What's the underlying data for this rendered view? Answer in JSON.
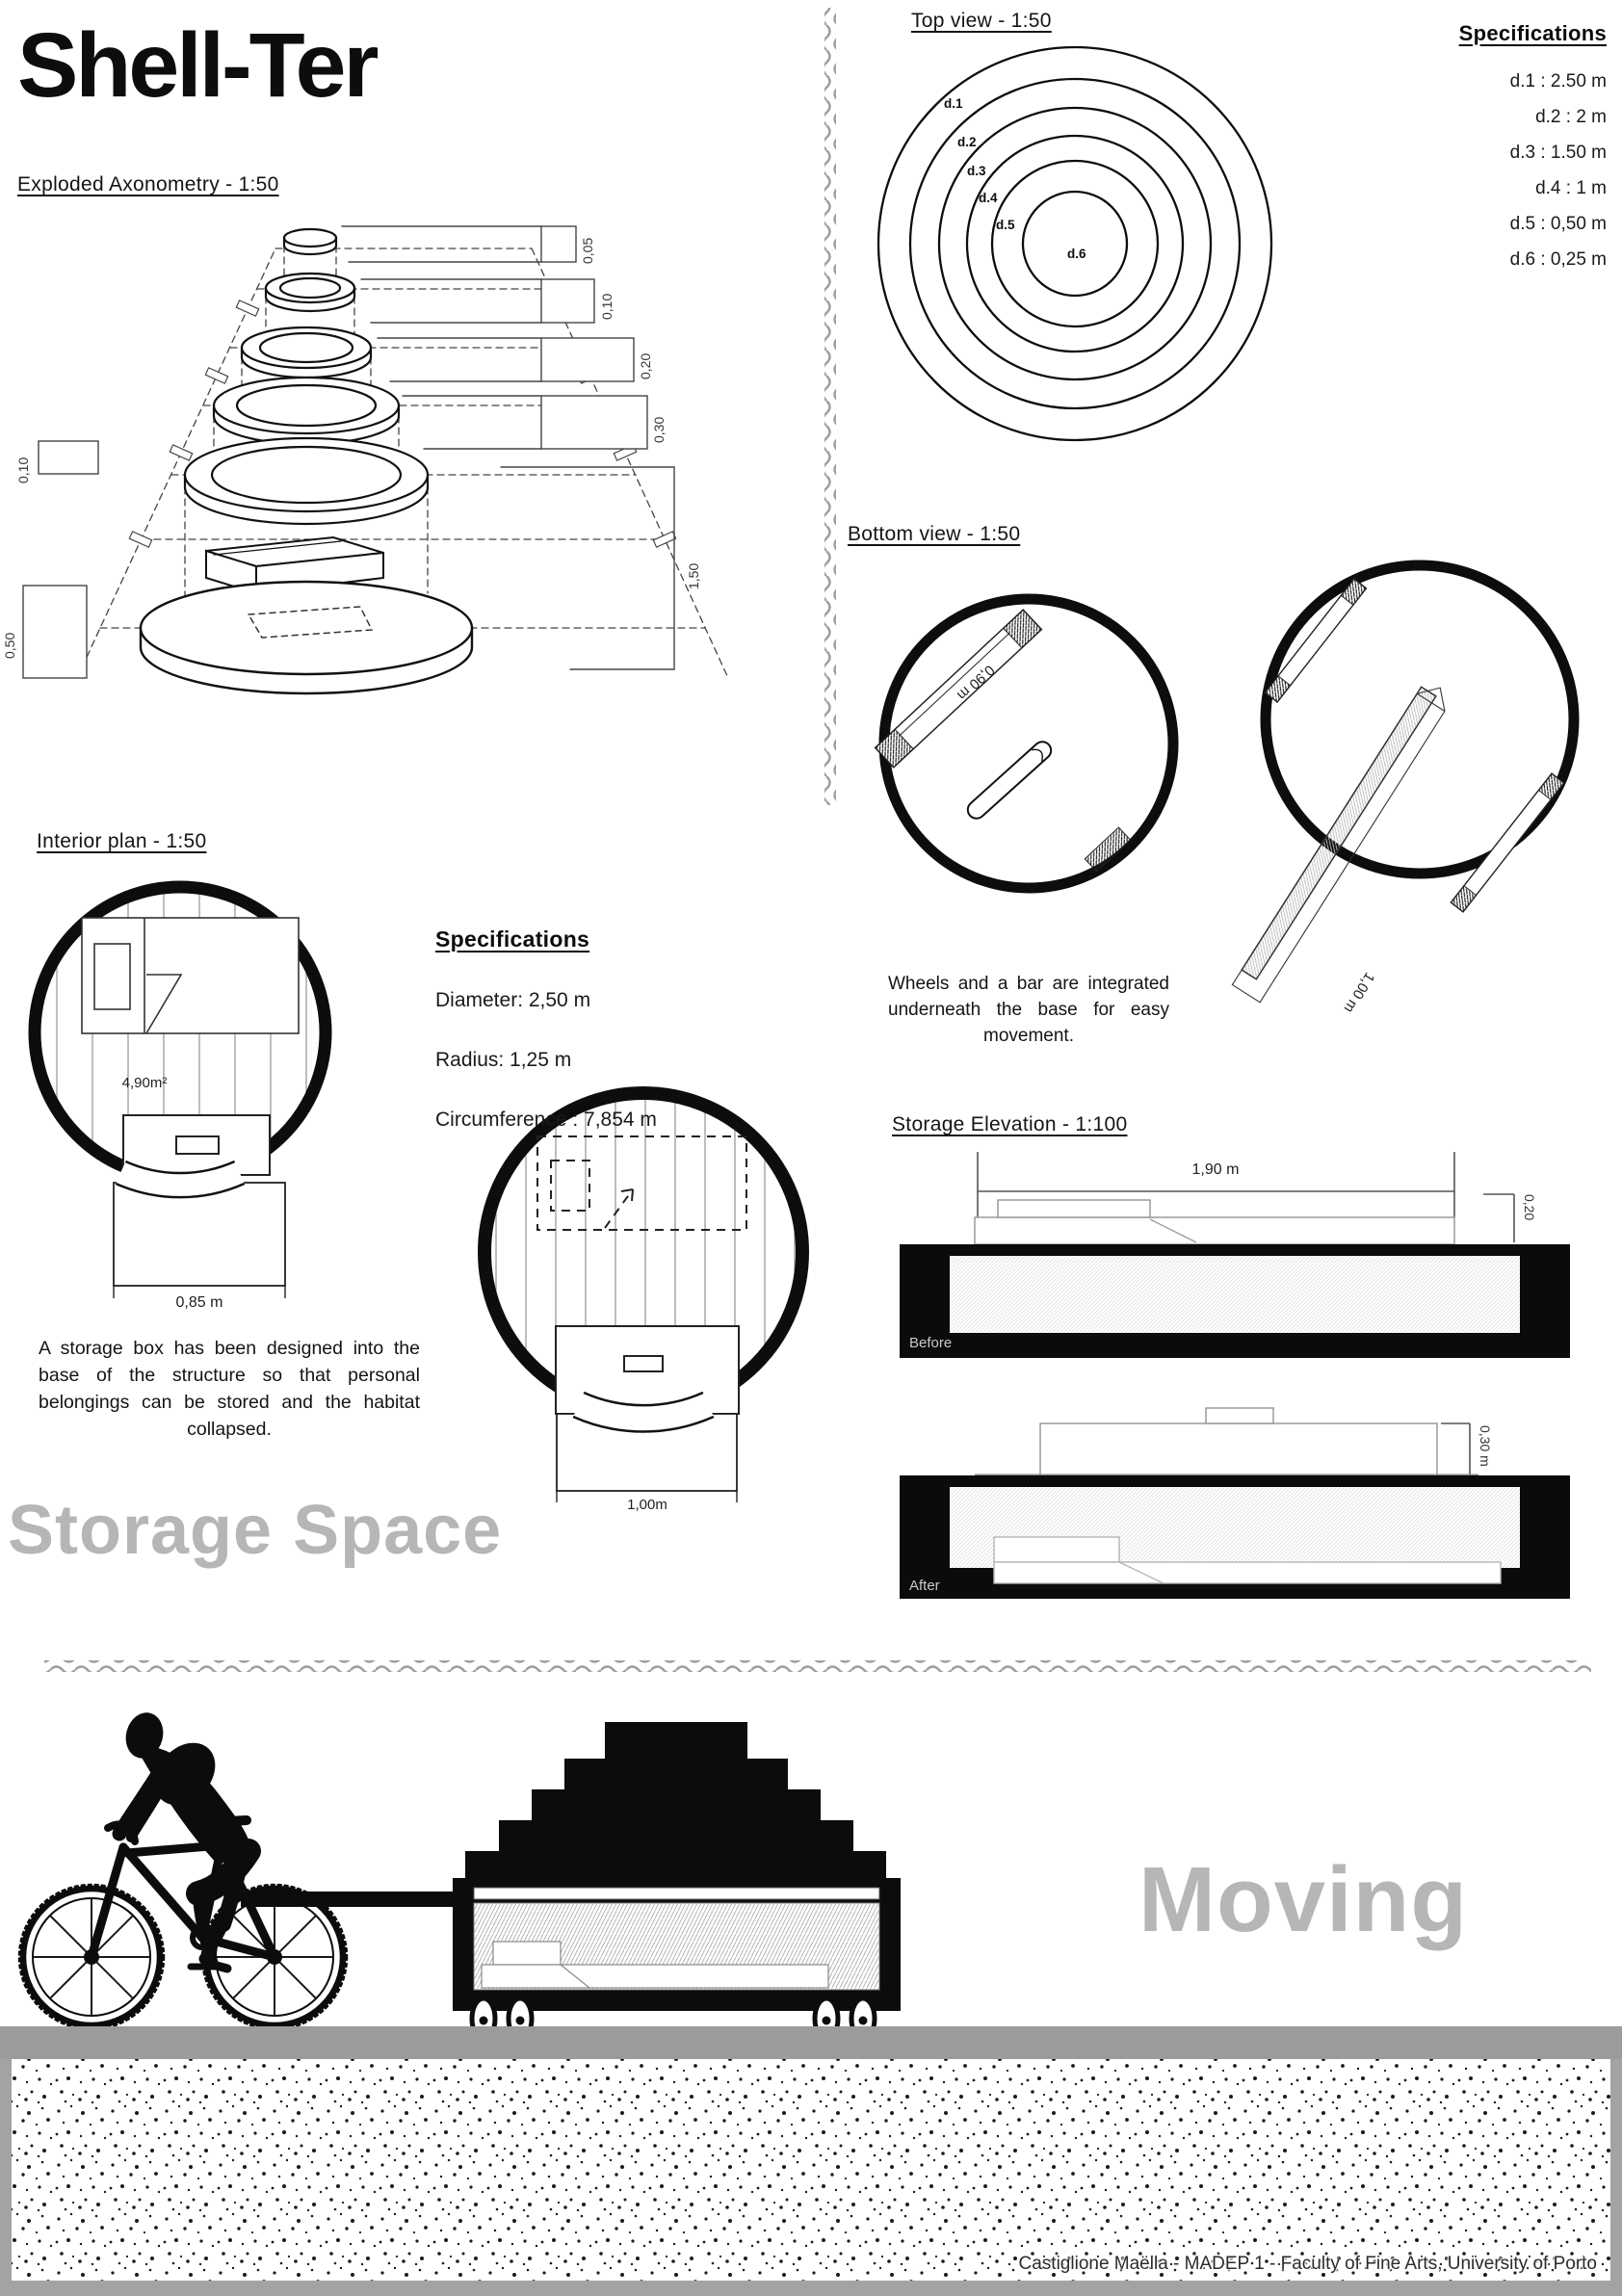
{
  "title": "Shell-Ter",
  "exploded": {
    "heading": "Exploded Axonometry - 1:50",
    "dims": {
      "h1": "0,05",
      "h2": "0,10",
      "h3": "0,20",
      "h4": "0,30",
      "total": "1,50",
      "left_top": "0,10",
      "left_base": "0,50"
    }
  },
  "top_view": {
    "heading": "Top view - 1:50",
    "ring_labels": [
      "d.1",
      "d.2",
      "d.3",
      "d.4",
      "d.5",
      "d.6"
    ]
  },
  "specs_top": {
    "heading": "Specifications",
    "items": [
      "d.1 : 2.50 m",
      "d.2 : 2 m",
      "d.3 : 1.50 m",
      "d.4 : 1 m",
      "d.5 : 0,50 m",
      "d.6 : 0,25 m"
    ]
  },
  "bottom_view": {
    "heading": "Bottom view - 1:50",
    "bar_left": "0,90 m",
    "bar_right": "1,00 m",
    "caption": "Wheels and a bar are integrated underneath the base for easy movement."
  },
  "interior": {
    "heading": "Interior plan - 1:50",
    "area": "4,90m²",
    "box_width_left": "0,85 m",
    "box_width_right": "1,00m",
    "note": "A storage box has been designed into the base of the structure so that personal belongings can be stored and the habitat collapsed."
  },
  "specs_mid": {
    "heading": "Specifications",
    "items": [
      "Diameter: 2,50 m",
      "Radius: 1,25 m",
      "Circumference : 7,854 m"
    ]
  },
  "storage_elevation": {
    "heading": "Storage Elevation - 1:100",
    "width": "1,90 m",
    "height_before": "0,20",
    "height_after": "0,30 m",
    "label_before": "Before",
    "label_after": "After"
  },
  "big_labels": {
    "storage": "Storage Space",
    "moving": "Moving"
  },
  "footer": "Castiglione Maëlla - MADEP 1 - Faculty of Fine Arts, University of Porto",
  "colors": {
    "ink": "#0d0d0d",
    "soft_gray": "#b6b6b6",
    "ground_gray": "#9b9b9b"
  }
}
